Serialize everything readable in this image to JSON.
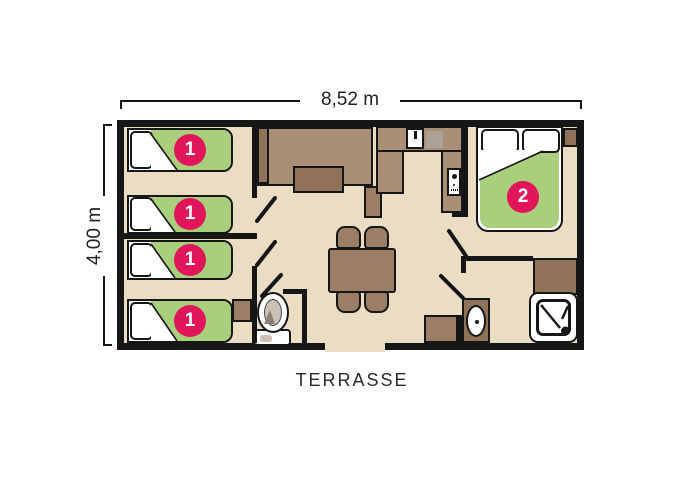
{
  "dimensions": {
    "width": "8,52 m",
    "height": "4,00 m"
  },
  "labels": {
    "terrace": "TERRASSE"
  },
  "badges": {
    "single": "1",
    "double": "2"
  },
  "rooms": {
    "children_bedroom": {
      "badge": "1",
      "single_bed_count": 4
    },
    "master_bedroom": {
      "badge": "2",
      "double_bed_count": 1
    }
  },
  "fixtures": [
    "single-bed",
    "double-bed",
    "pillow",
    "sofa-bench",
    "coffee-table",
    "kitchen-counter",
    "kitchen-sink",
    "stove",
    "fridge",
    "dining-table",
    "chair",
    "toilet",
    "washbasin",
    "shower",
    "wardrobe",
    "cabinet"
  ],
  "colors": {
    "floor": "#EBDCC4",
    "wall": "#161616",
    "bed_green": "#A9CE7C",
    "badge_pink": "#E0155A",
    "furniture_light": "#A98F75",
    "furniture_mid": "#9B7E63",
    "furniture_dark": "#8F7258",
    "stove_grey": "#ABA195",
    "fixture_grey": "#CBC0B5"
  }
}
